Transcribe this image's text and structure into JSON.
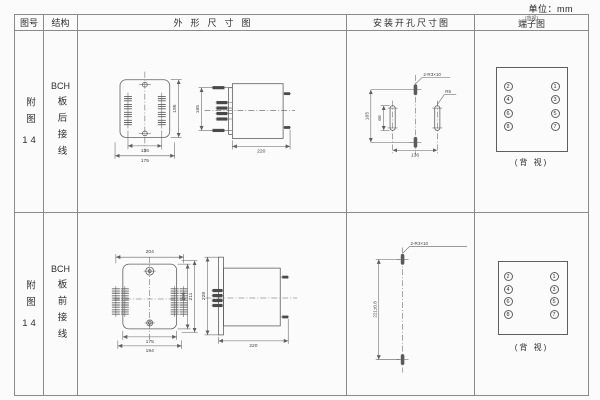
{
  "unit_label": "单位：mm",
  "colors": {
    "line": "#5f5f5f",
    "grid": "#8a8a8a",
    "text": "#2f2f2f"
  },
  "header": {
    "figure": "图号",
    "structure": "结构",
    "outline": "外形尺寸图",
    "install": "安装开孔尺寸图",
    "terminal": "端子图",
    "terminal_note": "(背视)"
  },
  "rows": [
    {
      "figure_label": "附图",
      "figure_num": "14",
      "structure_prefix": "BCH",
      "structure_rest": "板后接线",
      "outline": {
        "front": {
          "inner_width": "136",
          "width": "175",
          "height": "195"
        },
        "side": {
          "height": "165",
          "depth": "220"
        }
      },
      "install": {
        "height": "165",
        "slot_len": "66",
        "width": "136",
        "hole_note": "2-R3×10",
        "radius_note": "R5"
      },
      "terminal": {
        "left": [
          "2",
          "4",
          "6",
          "8"
        ],
        "right": [
          "1",
          "3",
          "5",
          "7"
        ],
        "caption": "(背 视)"
      }
    },
    {
      "figure_label": "附图",
      "figure_num": "14",
      "structure_prefix": "BCH",
      "structure_rest": "板前接线",
      "outline": {
        "front": {
          "top_width": "204",
          "inner_width": "175",
          "width": "194",
          "height1": "195",
          "height2": "211",
          "height3": "228"
        },
        "side": {
          "depth": "220"
        }
      },
      "install": {
        "height": "221±0.8",
        "hole_note": "2-R3×10"
      },
      "terminal": {
        "left": [
          "2",
          "4",
          "6",
          "8"
        ],
        "right": [
          "1",
          "3",
          "5",
          "7"
        ],
        "caption": "(背 视)"
      }
    }
  ]
}
